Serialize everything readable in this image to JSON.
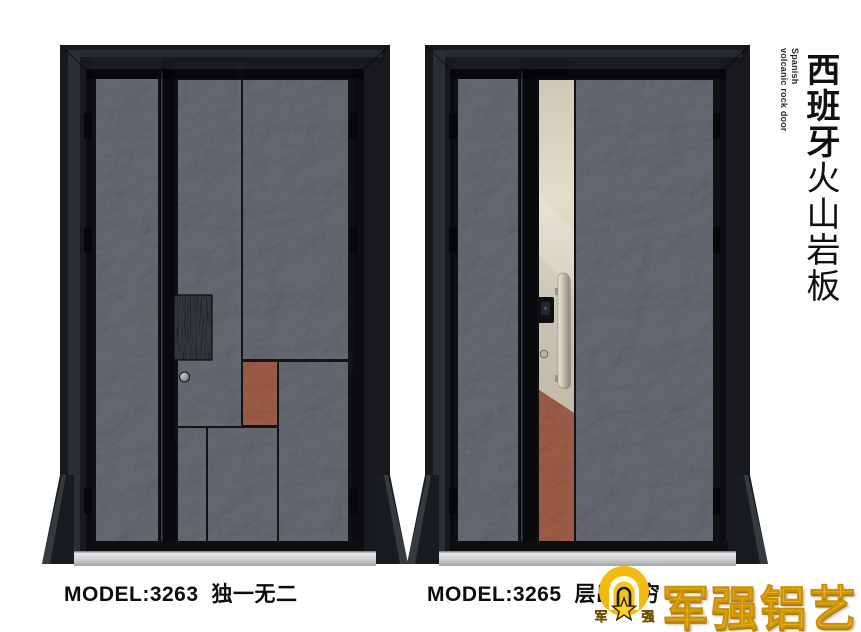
{
  "page": {
    "background": "#ffffff"
  },
  "header": {
    "title_cn_bold": "西班牙",
    "title_cn_regular": "火山岩板",
    "subtitle_en_line1": "Spanish",
    "subtitle_en_line2": "volcanic rock door"
  },
  "products": [
    {
      "model": "MODEL:3263",
      "name": "独一无二"
    },
    {
      "model": "MODEL:3265",
      "name": "层出不穷"
    }
  ],
  "brand": {
    "logo_text": "军强铝艺",
    "badge_char_left": "军",
    "badge_char_right": "强"
  },
  "colors": {
    "frame_black": "#17191c",
    "panel_grey": "#5d6269",
    "rust_accent": "#96543c",
    "champagne": "#d7d0c0",
    "lock_plate_dark": "#34373b",
    "logo_gold": "#f2b70d",
    "text_black": "#101010"
  }
}
